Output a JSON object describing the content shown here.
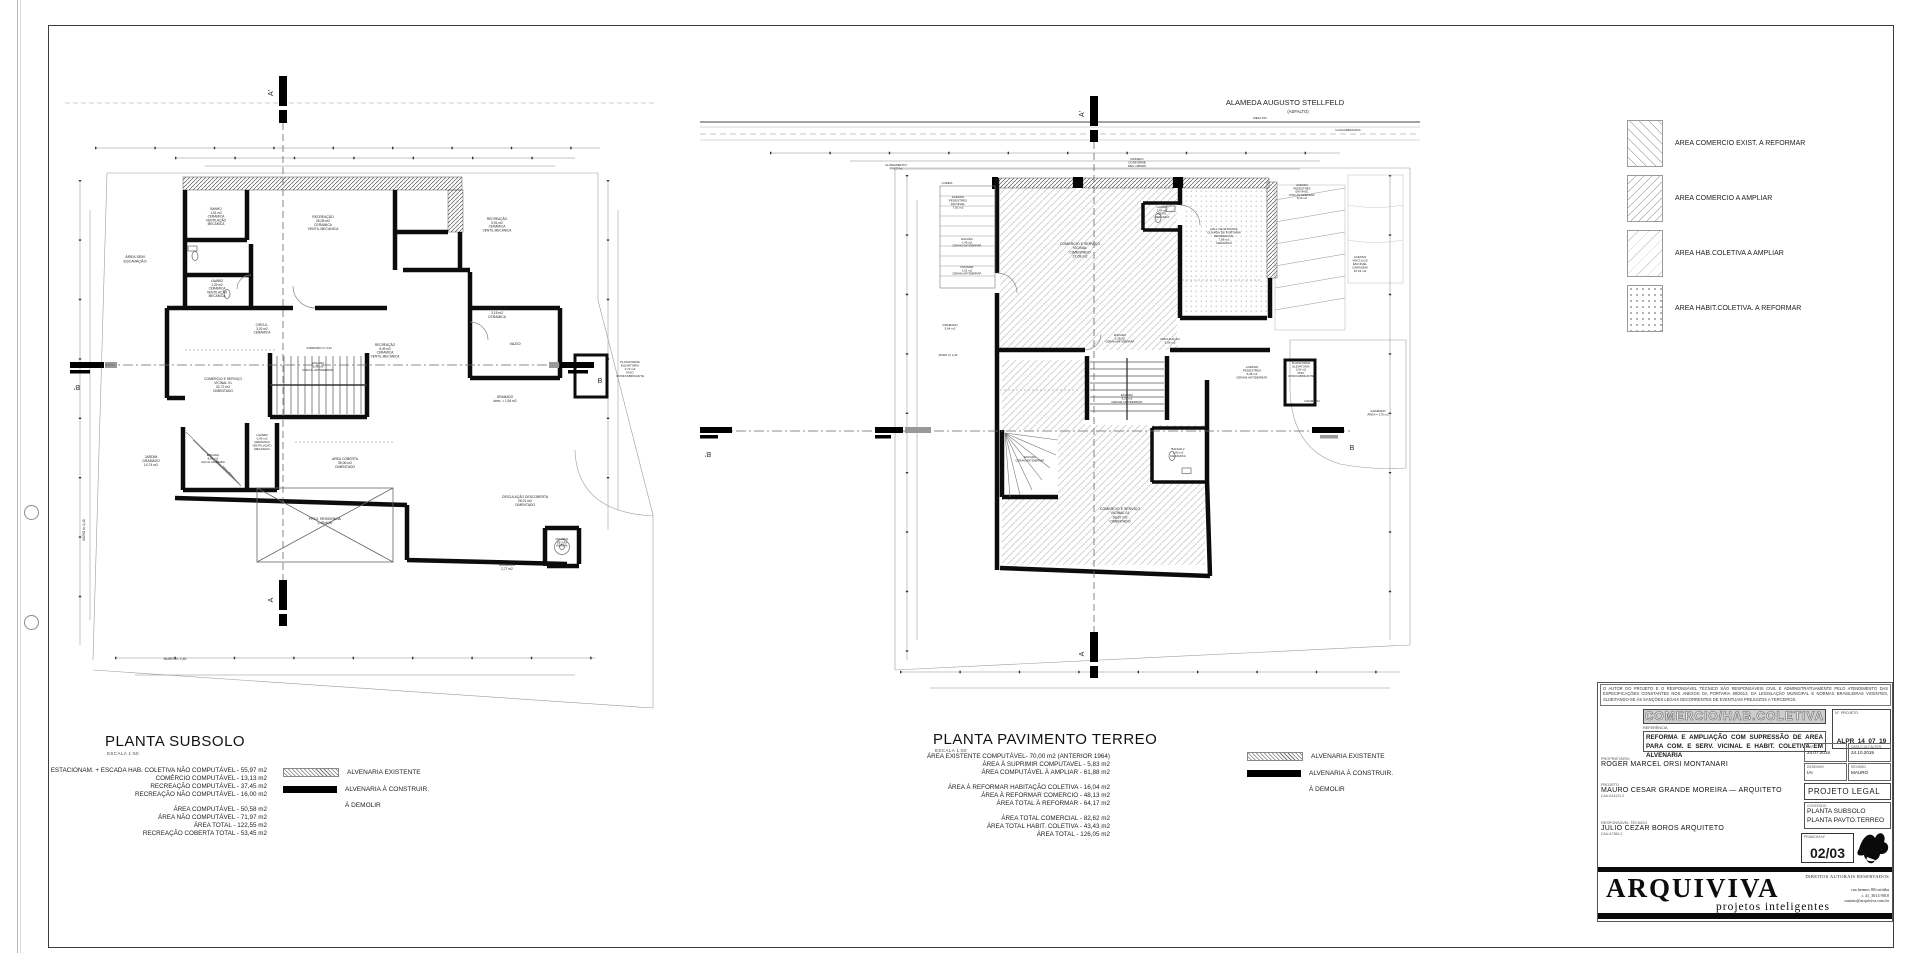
{
  "plans": {
    "subsolo": {
      "title": "PLANTA SUBSOLO",
      "scale": "ESCALA  1:50",
      "stats": [
        [
          "ESTACIONAM. + ESCADA HAB. COLETIVA  NÃO COMPUTÁVEL - 55,97 m2",
          "COMÉRCIO COMPUTÁVEL - 13,13 m2",
          "RECREAÇÃO COMPUTÁVEL - 37,45 m2",
          "RECREAÇÃO NÃO COMPUTÁVEL - 16,00 m2"
        ],
        [
          "ÁREA COMPUTÁVEL - 50,58 m2",
          "ÁREA NÃO COMPUTÁVEL - 71,97 m2",
          "ÁREA TOTAL - 122,55 m2",
          "RECREAÇÃO COBERTA TOTAL - 53,45 m2"
        ]
      ],
      "labels": [
        {
          "t": "ÁREA SEM|ESCAVAÇÃO",
          "x": 80,
          "y": 198,
          "s": 3.8
        },
        {
          "t": "BANHO|1,91 m2|CERAMICA|VENTILAÇÃO|MECANICA",
          "x": 161,
          "y": 150,
          "s": 3.2
        },
        {
          "t": "RECREAÇÃO|26,05 m2|CERAMICA|VENTIL.MECANICA",
          "x": 268,
          "y": 158,
          "s": 3.4
        },
        {
          "t": "RECREAÇÃO|5,91 m2|CERAMICA|VENTIL.MECANICA",
          "x": 442,
          "y": 160,
          "s": 3.2
        },
        {
          "t": "LAVABO|1,29 m2|CERAMICA|VENTILAÇÃO|MECANICA",
          "x": 162,
          "y": 222,
          "s": 3.2
        },
        {
          "t": "VESTIBULO|3,15 m2|CERAMICA",
          "x": 442,
          "y": 250,
          "s": 3.4
        },
        {
          "t": "CIRCUL.|3,02 m2|CERAMICA",
          "x": 207,
          "y": 266,
          "s": 3.2
        },
        {
          "t": "RECREAÇÃO|5,49 m2|CERAMICA|VENTIL.MECANICA",
          "x": 330,
          "y": 286,
          "s": 3.2
        },
        {
          "t": "VAZIO",
          "x": 460,
          "y": 285,
          "s": 3.8
        },
        {
          "t": "CORRIMÃO h= 0,92",
          "x": 264,
          "y": 289,
          "s": 2.8
        },
        {
          "t": "COMERCIO E SERVIÇO|VICINAL 01|32,72 m2|CIMENTADO",
          "x": 168,
          "y": 320,
          "s": 3.4
        },
        {
          "t": "ESCADA|8,06 m2|CIRCUL.ANTIDERRAP.",
          "x": 263,
          "y": 304,
          "s": 3
        },
        {
          "t": "PLATAFORMA|ELEVATORIA|2,72 m2|PISO|CONF.FABRICANTE",
          "x": 575,
          "y": 303,
          "s": 3
        },
        {
          "t": "GRAMADO|desn. = 1,54 m2",
          "x": 450,
          "y": 338,
          "s": 3.2
        },
        {
          "t": "LAVABO|0,96 m2|CERAMICA|VENTILAÇÃO|MECANICA",
          "x": 207,
          "y": 376,
          "s": 3
        },
        {
          "t": "JARDIM|GRAMADO|14,74 m2",
          "x": 96,
          "y": 398,
          "s": 3.4
        },
        {
          "t": "ESCADA|8,61 m2|AÇO E MADEIRA",
          "x": 158,
          "y": 396,
          "s": 3
        },
        {
          "t": "AREA COBERTA|35,06 m2|CIMENTADO",
          "x": 290,
          "y": 400,
          "s": 3.4
        },
        {
          "t": "PROJ. RESIDENCIA|2,40x6,00",
          "x": 270,
          "y": 460,
          "s": 3.4
        },
        {
          "t": "CIRCULAÇÃO DESCOBERTA|26,01 m2|CIMENTADO",
          "x": 470,
          "y": 438,
          "s": 3.4
        },
        {
          "t": "GRAMADO|2,77 m2",
          "x": 452,
          "y": 506,
          "s": 3.2
        },
        {
          "t": "CENTRAL|DE GÁS|HIDROM.",
          "x": 507,
          "y": 480,
          "s": 2.8
        },
        {
          "t": "MURO h= 2,40",
          "x": 120,
          "y": 600,
          "s": 3.4
        },
        {
          "t": "MURO h= 2,40",
          "x": 30,
          "y": 470,
          "s": 3.2,
          "r": -90
        },
        {
          "t": "A'",
          "x": 218,
          "y": 33,
          "s": 7,
          "r": -90,
          "n": "section-marker-label"
        },
        {
          "t": "A",
          "x": 218,
          "y": 540,
          "s": 7,
          "r": -90,
          "n": "section-marker-label"
        },
        {
          "t": "B'",
          "x": 22,
          "y": 325,
          "s": 7,
          "r": 180,
          "n": "section-marker-label"
        },
        {
          "t": "B",
          "x": 545,
          "y": 323,
          "s": 7,
          "n": "section-marker-label"
        }
      ]
    },
    "terreo": {
      "title": "PLANTA PAVIMENTO TERREO",
      "scale": "ESCALA  1:50",
      "stats": [
        [
          "ÁREA EXISTENTE COMPUTÁVEL- 70,00 m2 (ANTERIOR 1964)",
          "ÁREA À SUPRIMIR COMPUTAVEL - 5,83 m2",
          "ÁREA COMPUTÁVEL À AMPLIAR - 61,88 m2"
        ],
        [
          "ÁREA À REFORMAR HABITAÇÃO COLETIVA - 16,04 m2",
          "ÁREA À REFORMAR COMERCIO  - 48,13 m2",
          "ÁREA TOTAL À REFORMAR - 64,17 m2"
        ],
        [
          "ÁREA TOTAL COMERCIAL - 82,62 m2",
          "ÁREA TOTAL HABIT. COLETIVA - 43,43 m2",
          "ÁREA TOTAL - 126,05 m2"
        ]
      ],
      "labels": [
        {
          "t": "ALAMEDA AUGUSTO STELLFELD",
          "x": 585,
          "y": 45,
          "s": 7.5,
          "n": "street-name"
        },
        {
          "t": "(ASFALTO)",
          "x": 598,
          "y": 53,
          "s": 4.2,
          "n": "street-surface"
        },
        {
          "t": "MEIO FIO",
          "x": 560,
          "y": 59,
          "s": 3
        },
        {
          "t": "GUIA REBAIXADA",
          "x": 648,
          "y": 71,
          "s": 3
        },
        {
          "t": "PASSEIO|CONFORME|DEC.1066/06",
          "x": 437,
          "y": 100,
          "s": 3
        },
        {
          "t": "ALINHAMENTO|PREDIAL",
          "x": 196,
          "y": 106,
          "s": 3
        },
        {
          "t": "LIXEIRA",
          "x": 247,
          "y": 124,
          "s": 2.8
        },
        {
          "t": "ACESSO|PEDESTRES|EM NIVEL|7,62 m2",
          "x": 258,
          "y": 138,
          "s": 3
        },
        {
          "t": "ESCADA|1,45 m2|CERAM.ANTIDERRAP.",
          "x": 267,
          "y": 180,
          "s": 2.8
        },
        {
          "t": "PATAMAR|1,61 m2|CERAM.ANTIDERRAP.",
          "x": 267,
          "y": 208,
          "s": 2.8
        },
        {
          "t": "COMERCIO E SERVIÇO|VICINAL|CIMENTADO|37,08 m2",
          "x": 380,
          "y": 185,
          "s": 3.6
        },
        {
          "t": "LAVABO|1,64 m2|VENTIL.|MECANICA",
          "x": 462,
          "y": 148,
          "s": 2.8
        },
        {
          "t": "HALL DE ENTRADA|GUARDA DE PORTARIA|RESIDENCIAL|7,88 m2|CERAMICA",
          "x": 524,
          "y": 170,
          "s": 3
        },
        {
          "t": "ACESSO|PEDESTRES|EM NIVEL|PISO ANTIDERRAP.|8,30 m2",
          "x": 602,
          "y": 126,
          "s": 2.8
        },
        {
          "t": "ACESSO|VEICULOS|EM NIVEL|GARAGEM|15,43 m2",
          "x": 660,
          "y": 198,
          "s": 3
        },
        {
          "t": "GRAMADO|5,64 m2",
          "x": 250,
          "y": 266,
          "s": 3
        },
        {
          "t": "MURO h= 2,40",
          "x": 248,
          "y": 296,
          "s": 2.8
        },
        {
          "t": "CIRCULAÇÃO|5,06 m2",
          "x": 470,
          "y": 280,
          "s": 3
        },
        {
          "t": "ESCADA|1,38 m2|CERAM.ANTIDERRAP.",
          "x": 420,
          "y": 276,
          "s": 2.8
        },
        {
          "t": "ACESSO|PEDESTRES|5,08 m2|CERAM.ANTIDERRAP.",
          "x": 552,
          "y": 308,
          "s": 3
        },
        {
          "t": "PLATAFORMA|ELEVATORIA|2,04 m2|PISO|CONF.FABRICANTE",
          "x": 601,
          "y": 304,
          "s": 2.8
        },
        {
          "t": "ESCADA|5,23 m2|CERAM.ANTIDERRAP.",
          "x": 427,
          "y": 336,
          "s": 3
        },
        {
          "t": "GRAMADO",
          "x": 612,
          "y": 342,
          "s": 3
        },
        {
          "t": "GRAMADO|ÁREA = 176 m2",
          "x": 678,
          "y": 352,
          "s": 3
        },
        {
          "t": "ESCADA|CERAM.ANTIDERRAP.",
          "x": 330,
          "y": 398,
          "s": 2.8
        },
        {
          "t": "BANHO 2|1,90 m2|CERAMICA",
          "x": 478,
          "y": 390,
          "s": 3
        },
        {
          "t": "COMERCIO E SERVIÇO|VICINAL 01|38,87 m2|CIMENTADO",
          "x": 420,
          "y": 450,
          "s": 3.6
        },
        {
          "t": "A'",
          "x": 384,
          "y": 54,
          "s": 7,
          "r": -90,
          "n": "section-marker-label"
        },
        {
          "t": "A",
          "x": 384,
          "y": 594,
          "s": 7,
          "r": -90,
          "n": "section-marker-label"
        },
        {
          "t": "B'",
          "x": 8,
          "y": 392,
          "s": 7,
          "r": 180,
          "n": "section-marker-label"
        },
        {
          "t": "B",
          "x": 652,
          "y": 390,
          "s": 7,
          "n": "section-marker-label"
        }
      ]
    }
  },
  "wall_legend": {
    "items": [
      {
        "label": "ALVENARIA EXISTENTE",
        "swatch": "hatch"
      },
      {
        "label": "ALVENARIA À CONSTRUIR.",
        "swatch": "solid"
      },
      {
        "label": "À DEMOLIR",
        "swatch": "dashed"
      }
    ]
  },
  "area_legend": {
    "items": [
      {
        "label": "AREA COMERCIO EXIST. A REFORMAR",
        "swatch": "asw-1"
      },
      {
        "label": "AREA COMERCIO A AMPLIAR",
        "swatch": "asw-2"
      },
      {
        "label": "AREA HAB.COLETIVA A AMPLIAR",
        "swatch": "asw-3"
      },
      {
        "label": "AREA HABIT.COLETIVA. A REFORMAR",
        "swatch": "asw-4"
      }
    ]
  },
  "titleblock": {
    "disclaimer": "O AUTOR DO PROJETO E O RESPONSÁVEL TÉCNICO SÃO RESPONSÁVEIS CIVIL E ADMINISTRATIVAMENTE PELO ATENDIMENTO DAS ESPECIFICAÇÕES CONSTANTES NOS ANEXOS DA PORTARIA 80/2013, DA LEGISLAÇÃO MUNICIPAL E NORMAS BRASILEIRAS VIGENTES, SUJEITANDO-SE ÀS SANÇÕES LEGAIS DECORRENTES DE EVENTUAIS PREJUÍZOS A TERCEIROS.",
    "category": "COMERCIO/HAB.COLETIVA",
    "referencia_label": "REFERÊNCIA",
    "referencia": "REFORMA E AMPLIAÇÃO COM SUPRESSÃO DE AREA PARA COM. E SERV. VICINAL E HABIT. COLETIVA EM ALVENARIA",
    "n_projeto_label": "N°. PROJETO",
    "n_projeto": "ALPR_14_07_19",
    "proprietario_label": "PROPRIETÁRIO",
    "proprietario": "ROGER  MARCEL  ORSI  MONTANARI",
    "projeto_label": "PROJETO",
    "projeto": "MAURO  CESAR  GRANDE  MOREIRA  —  ARQUITETO",
    "projeto_cau": "CAU A14131-2",
    "resp_label": "RESPONSÁVEL  TÉCNICO",
    "resp": "JULIO  CEZAR  BOROS  ARQUITETO",
    "resp_cau": "CAU A7360-2",
    "data_label": "DATA",
    "data": "24.07.2019",
    "alter_label": "DATA C.ULT.ALTER.",
    "alter": "24.10.2019",
    "desenho_label": "DESENHO",
    "desenho": "IAI",
    "revisao_label": "REVISÃO",
    "revisao": "MAURO",
    "fase": "PROJETO  LEGAL",
    "conteudo_label": "CONTEÚDO",
    "conteudo_lines": [
      "PLANTA  SUBSOLO",
      "PLANTA  PAVTO.TERREO"
    ],
    "prancha_label": "PRANCHA Nº",
    "prancha": "02/03",
    "rights": "DIREITOS AUTORAIS RESERVADOS",
    "brand": "ARQUIVIVA",
    "brand_sub": "projetos inteligentes",
    "contact_lines": [
      "rua hermes 80/curitiba",
      "t. 41_3014 9018",
      "contato@arquiviva.com.br"
    ]
  }
}
